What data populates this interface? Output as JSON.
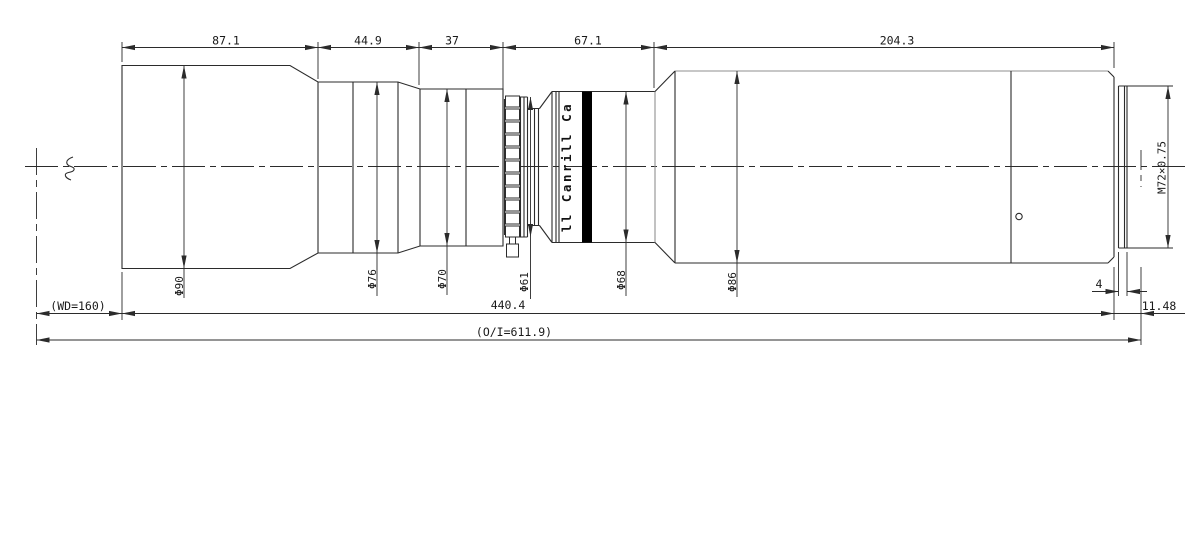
{
  "dimensions": {
    "top": [
      {
        "label": "87.1"
      },
      {
        "label": "44.9"
      },
      {
        "label": "37"
      },
      {
        "label": "67.1"
      },
      {
        "label": "204.3"
      }
    ],
    "diameters": [
      {
        "label": "Φ90"
      },
      {
        "label": "Φ76"
      },
      {
        "label": "Φ70"
      },
      {
        "label": "Φ61"
      },
      {
        "label": "Φ68"
      },
      {
        "label": "Φ86"
      }
    ],
    "thread": {
      "label": "M72×0.75"
    },
    "thread_length": {
      "label": "4"
    },
    "flange_distance": {
      "label": "11.48"
    },
    "working_distance": {
      "label": "(WD=160)"
    },
    "overall_length": {
      "label": "440.4"
    },
    "object_to_image": {
      "label": "(O/I=611.9)"
    }
  },
  "barrel_text": {
    "label": "ll Canrill Ca"
  },
  "colors": {
    "line": "#2b2b2b",
    "soft_line": "#8f8f8f",
    "band": "#000000",
    "background": "#ffffff",
    "text": "#1a1a1a"
  }
}
